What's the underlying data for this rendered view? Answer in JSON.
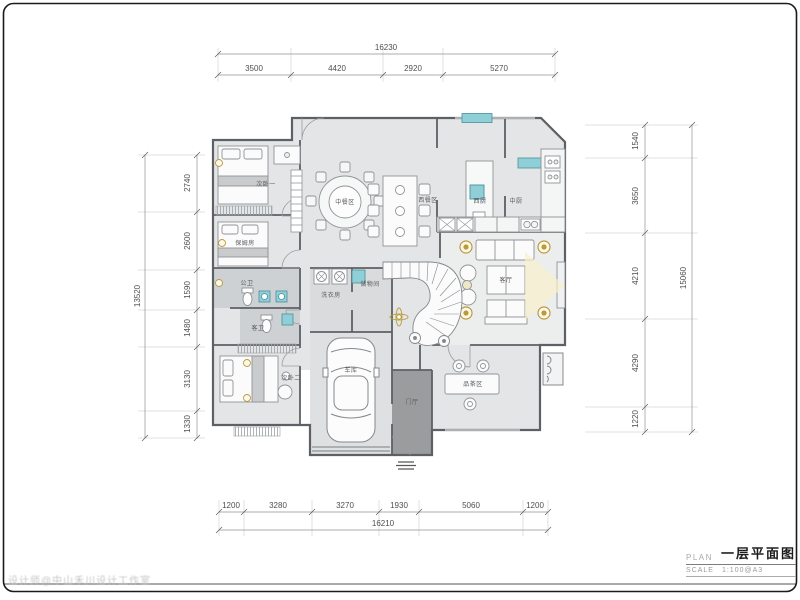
{
  "title_block": {
    "plan_label": "PLAN",
    "plan_title": "一层平面图",
    "scale_label": "SCALE",
    "scale_value": "1:100@A3"
  },
  "watermark": "设计师@中山禾川设计工作室",
  "rooms": {
    "bedroom1": "次卧一",
    "nanny": "保姆房",
    "public_bath": "公卫",
    "guest_bath": "客卫",
    "bedroom2": "次卧二",
    "garage": "车库",
    "foyer": "门厅",
    "laundry": "洗衣房",
    "storage": "储物间",
    "chinese_dining": "中餐区",
    "western_dining": "西餐区",
    "western_kitchen": "西厨",
    "chinese_kitchen": "中厨",
    "living": "客厅",
    "tea": "品茶区"
  },
  "dimensions": {
    "top": {
      "total": "16230",
      "segments": [
        "3500",
        "4420",
        "2920",
        "5270"
      ]
    },
    "bottom": {
      "total": "16210",
      "segments": [
        "1200",
        "3280",
        "3270",
        "1930",
        "5060",
        "1200"
      ]
    },
    "left": {
      "total": "13520",
      "segments": [
        "2740",
        "2600",
        "1590",
        "1480",
        "3130",
        "1330"
      ]
    },
    "right": {
      "total": "15060",
      "segments": [
        "1540",
        "3650",
        "4210",
        "4290",
        "1220"
      ]
    }
  },
  "colors": {
    "wall": "#5d6064",
    "floor": "#e4e5e6",
    "bath_floor": "#ced1d3",
    "foyer_fill": "#9a9c9e",
    "window_teal": "#8fd0d8",
    "accent_gold": "#b99b3e",
    "light_beam": "#f8f0ca"
  }
}
